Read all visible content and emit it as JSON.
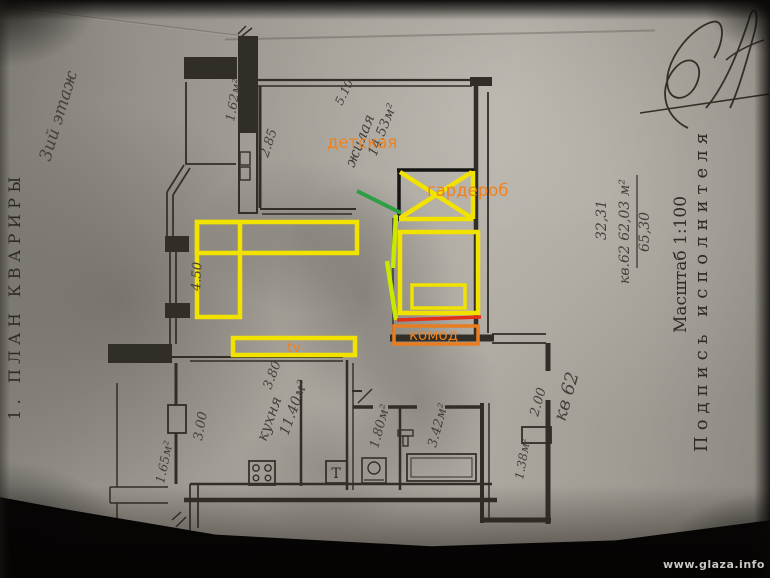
{
  "photo": {
    "watermark": "www.glaza.info"
  },
  "margins": {
    "plan_title": "1. ПЛАН КВАРИРЫ",
    "floor_note": "3ий этаж",
    "scale_label": "Масштаб 1:100",
    "signature_label": "Подпись исполнителя",
    "apartment_ref": "кв 62",
    "area_upper": "32,31",
    "area_main": "кв.62 62,03 м²",
    "area_lower": "65,30"
  },
  "rooms": {
    "living": {
      "name": "жилая",
      "area": "14.53м²",
      "width": "5.10",
      "depth": "2.85"
    },
    "kitchen": {
      "name": "кухня",
      "area": "11.40м²",
      "window": "3.00"
    },
    "balcony_top": {
      "area": "1.62м²"
    },
    "balcony_side": {
      "area": "1.65м²"
    },
    "wc": {
      "area": "1.80м²"
    },
    "bath": {
      "area": "3.42м²"
    },
    "entry": {
      "area": "1.38м²",
      "door": "2.00"
    },
    "lounge": {
      "width": "4.50",
      "length": "3.80"
    }
  },
  "fixtures": {
    "boiler": "Т"
  },
  "annotations": {
    "nursery": "детская",
    "wardrobe": "гардероб",
    "dresser": "комод",
    "tv": "tv"
  },
  "colors": {
    "furniture": "#f2e200",
    "accent_line": "#c8e800",
    "door_mark": "#2f9e44",
    "divider_line": "#e03018",
    "dresser_box": "#e87d20",
    "label_orange": "#ef821e",
    "ink": "#45403a",
    "wall": "#312d27"
  }
}
